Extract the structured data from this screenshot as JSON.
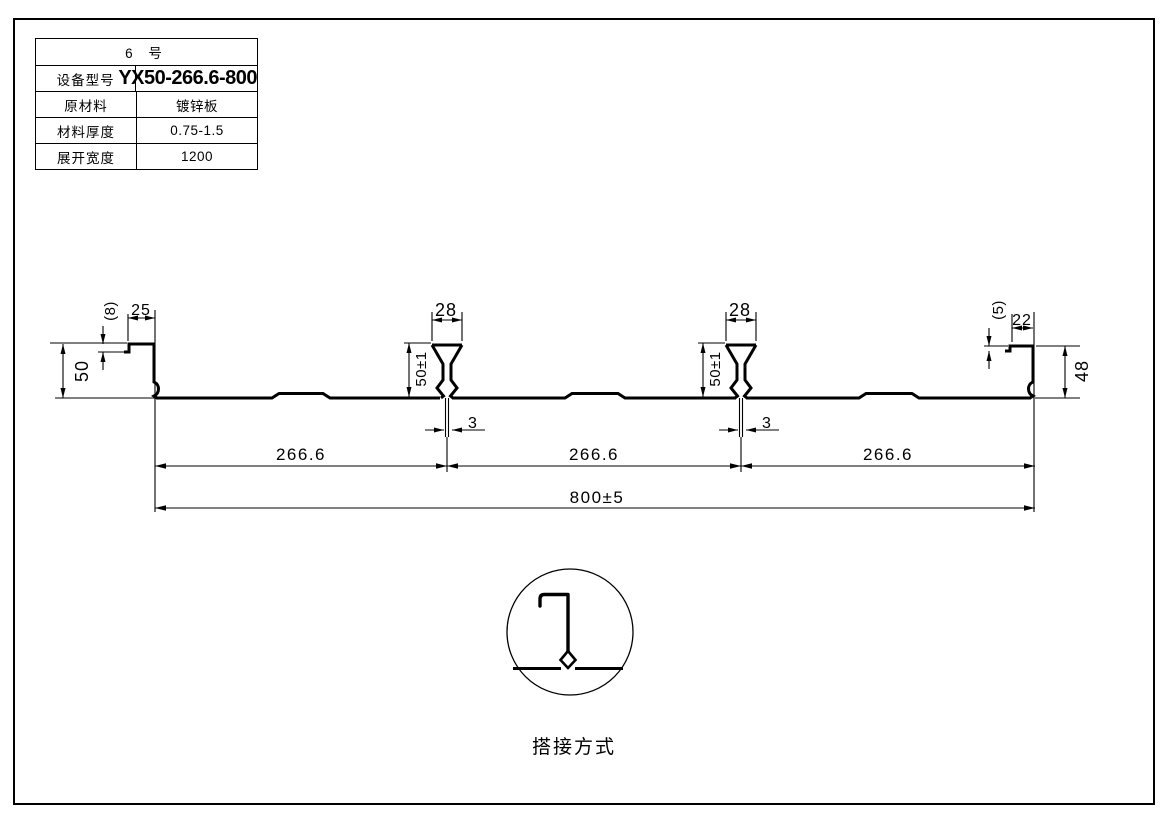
{
  "sheet": {
    "background": "#ffffff",
    "line_color": "#000000"
  },
  "table": {
    "title": "6 号",
    "rows": [
      {
        "label": "设备型号",
        "value": "YX50-266.6-800"
      },
      {
        "label": "原材料",
        "value": "镀锌板"
      },
      {
        "label": "材料厚度",
        "value": "0.75-1.5"
      },
      {
        "label": "展开宽度",
        "value": "1200"
      }
    ]
  },
  "drawing": {
    "dims": {
      "left_edge_step": "(8)",
      "left_lip_width": "25",
      "left_edge_height": "50",
      "rib_top_width": "28",
      "rib_height": "50±1",
      "seam_gap": "3",
      "span": "266.6",
      "overall_width": "800±5",
      "right_edge_step": "(5)",
      "right_lip_width": "22",
      "right_edge_height": "48"
    },
    "detail": {
      "label": "搭接方式"
    }
  }
}
